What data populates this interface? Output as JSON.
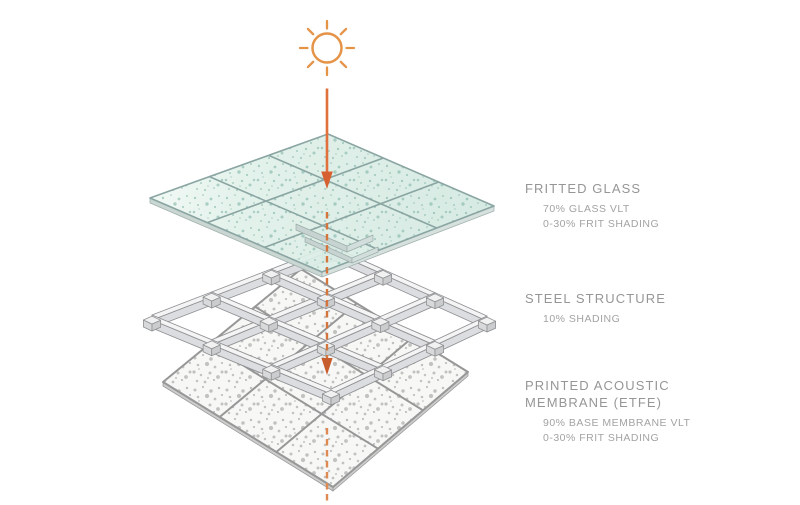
{
  "diagram": {
    "sun_icon": "sun",
    "colors": {
      "sun_orange": "#e59347",
      "arrow_orange": "#e0713c",
      "arrow_head": "#d66030",
      "mid_dash": "#d4763c",
      "mid_head": "#c75d2c",
      "bottom_dash": "#de8a50",
      "glass_grad_a": "#f2f9f5",
      "glass_grad_b": "#e0f0e9",
      "glass_grad_c": "#d2e8e0",
      "glass_line": "#8aa5a2",
      "glass_edge": "#c9d6d2",
      "glass_edge2": "#d6e1de",
      "glass_step": "#c6d3d0",
      "glass_step2": "#d2dedb",
      "frit_dot": "#85b8ab",
      "steel_top": "#f4f4f5",
      "steel_side": "#dcdde0",
      "steel_dark": "#cbccce",
      "steel_mid": "#d8d9db",
      "steel_joint_top": "#f1f1f2",
      "steel_line": "#8f9193",
      "membrane_fill": "#f7f7f5",
      "membrane_line": "#979797",
      "membrane_edge": "#cdcdcb",
      "membrane_dot": "#9f9f9f",
      "label_text": "#969696"
    }
  },
  "labels": [
    {
      "name": "FRITTED GLASS",
      "details": [
        "70% GLASS VLT",
        "0-30% FRIT SHADING"
      ]
    },
    {
      "name": "STEEL STRUCTURE",
      "details": [
        "10% SHADING"
      ]
    },
    {
      "name": "PRINTED ACOUSTIC MEMBRANE (ETFE)",
      "details": [
        "90% BASE MEMBRANE VLT",
        "0-30% FRIT SHADING"
      ]
    }
  ]
}
